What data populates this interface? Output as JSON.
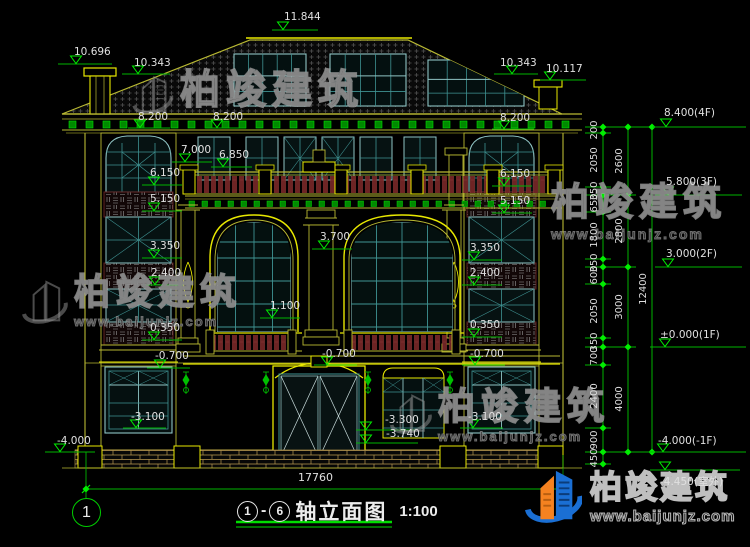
{
  "canvas": {
    "width": 750,
    "height": 547,
    "background": "#000000"
  },
  "brand": {
    "name": "柏竣建筑",
    "website": "www.baijunjz.com"
  },
  "title_block": {
    "axis_from": "1",
    "separator": "-",
    "axis_to": "6",
    "name": "轴立面图",
    "scale": "1:100"
  },
  "axis_bubble": "1",
  "dimensions": {
    "overall_width": "17760",
    "right_chain": {
      "line_x": [
        603,
        628,
        652
      ],
      "text_x": [
        595,
        620,
        644
      ],
      "ticks": [
        [
          127,
          133,
          187,
          195,
          212,
          259,
          267,
          284,
          338,
          347,
          365,
          428,
          452,
          464
        ],
        [
          127,
          195,
          267,
          347,
          452
        ],
        [
          127,
          452
        ]
      ],
      "labels": [
        [
          {
            "v": "200",
            "y": 130
          },
          {
            "v": "2050",
            "y": 160
          },
          {
            "v": "350",
            "y": 191
          },
          {
            "v": "650",
            "y": 203
          },
          {
            "v": "1800",
            "y": 235
          },
          {
            "v": "350",
            "y": 263
          },
          {
            "v": "600",
            "y": 275
          },
          {
            "v": "2050",
            "y": 311
          },
          {
            "v": "350",
            "y": 342
          },
          {
            "v": "700",
            "y": 356
          },
          {
            "v": "2400",
            "y": 396
          },
          {
            "v": "900",
            "y": 440
          },
          {
            "v": "450",
            "y": 458
          }
        ],
        [
          {
            "v": "2600",
            "y": 161
          },
          {
            "v": "2800",
            "y": 231
          },
          {
            "v": "3000",
            "y": 307
          },
          {
            "v": "4000",
            "y": 399
          }
        ],
        [
          {
            "v": "12400",
            "y": 289
          }
        ]
      ]
    }
  },
  "level_markers": [
    {
      "text": "11.844",
      "tx": 284,
      "ty": 12,
      "ly": 30,
      "lx1": 272,
      "lx2": 318,
      "trix": 283
    },
    {
      "text": "10.696",
      "tx": 74,
      "ty": 47,
      "ly": 64,
      "lx1": 58,
      "lx2": 112,
      "trix": 76
    },
    {
      "text": "10.343",
      "tx": 134,
      "ty": 58,
      "ly": 74,
      "lx1": 122,
      "lx2": 170,
      "trix": 138
    },
    {
      "text": "10.343",
      "tx": 500,
      "ty": 58,
      "ly": 74,
      "lx1": 494,
      "lx2": 538,
      "trix": 512
    },
    {
      "text": "10.117",
      "tx": 546,
      "ty": 64,
      "ly": 80,
      "lx1": 540,
      "lx2": 586,
      "trix": 550
    },
    {
      "text": "8.200",
      "tx": 138,
      "ty": 112,
      "ly": 128,
      "lx1": 128,
      "lx2": 170,
      "trix": 140
    },
    {
      "text": "8.200",
      "tx": 213,
      "ty": 112,
      "ly": 128,
      "lx1": 205,
      "lx2": 246,
      "trix": 217
    },
    {
      "text": "8.200",
      "tx": 500,
      "ty": 113,
      "ly": 129,
      "lx1": 492,
      "lx2": 534,
      "trix": 504
    },
    {
      "text": "7.000",
      "tx": 181,
      "ty": 145,
      "ly": 162,
      "lx1": 172,
      "lx2": 212,
      "trix": 185
    },
    {
      "text": "6.850",
      "tx": 219,
      "ty": 150,
      "ly": 167,
      "lx1": 211,
      "lx2": 252,
      "trix": 223
    },
    {
      "text": "6.150",
      "tx": 150,
      "ty": 168,
      "ly": 185,
      "lx1": 142,
      "lx2": 182,
      "trix": 154
    },
    {
      "text": "6.150",
      "tx": 500,
      "ty": 169,
      "ly": 186,
      "lx1": 492,
      "lx2": 532,
      "trix": 504
    },
    {
      "text": "5.150",
      "tx": 150,
      "ty": 194,
      "ly": 211,
      "lx1": 142,
      "lx2": 182,
      "trix": 154
    },
    {
      "text": "5.150",
      "tx": 500,
      "ty": 196,
      "ly": 213,
      "lx1": 492,
      "lx2": 532,
      "trix": 504
    },
    {
      "text": "3.700",
      "tx": 320,
      "ty": 232,
      "ly": 249,
      "lx1": 312,
      "lx2": 352,
      "trix": 324
    },
    {
      "text": "3.350",
      "tx": 150,
      "ty": 241,
      "ly": 258,
      "lx1": 142,
      "lx2": 182,
      "trix": 154
    },
    {
      "text": "3.350",
      "tx": 470,
      "ty": 243,
      "ly": 260,
      "lx1": 462,
      "lx2": 502,
      "trix": 474
    },
    {
      "text": "2.400",
      "tx": 151,
      "ty": 268,
      "ly": 285,
      "lx1": 143,
      "lx2": 183,
      "trix": 155
    },
    {
      "text": "2.400",
      "tx": 470,
      "ty": 268,
      "ly": 285,
      "lx1": 462,
      "lx2": 502,
      "trix": 474
    },
    {
      "text": "1.100",
      "tx": 270,
      "ty": 301,
      "ly": 318,
      "lx1": 260,
      "lx2": 300,
      "trix": 272
    },
    {
      "text": "0.350",
      "tx": 150,
      "ty": 323,
      "ly": 340,
      "lx1": 142,
      "lx2": 182,
      "trix": 154
    },
    {
      "text": "0.350",
      "tx": 470,
      "ty": 320,
      "ly": 337,
      "lx1": 462,
      "lx2": 502,
      "trix": 474
    },
    {
      "text": "-0.700",
      "tx": 155,
      "ty": 351,
      "ly": 368,
      "lx1": 147,
      "lx2": 190,
      "trix": 160
    },
    {
      "text": "-0.700",
      "tx": 322,
      "ty": 349,
      "ly": 365,
      "lx1": 314,
      "lx2": 357,
      "trix": 327
    },
    {
      "text": "-0.700",
      "tx": 470,
      "ty": 349,
      "ly": 365,
      "lx1": 462,
      "lx2": 505,
      "trix": 475
    },
    {
      "text": "-3.100",
      "tx": 131,
      "ty": 412,
      "ly": 428,
      "lx1": 123,
      "lx2": 166,
      "trix": 136
    },
    {
      "text": "-3.100",
      "tx": 468,
      "ty": 412,
      "ly": 428,
      "lx1": 460,
      "lx2": 503,
      "trix": 473
    },
    {
      "text": "-3.300",
      "tx": 385,
      "ty": 415,
      "ly": 430,
      "lx1": 356,
      "lx2": 416,
      "trix": 366
    },
    {
      "text": "-3.740",
      "tx": 386,
      "ty": 429,
      "ly": 443,
      "lx1": 356,
      "lx2": 418,
      "trix": 366
    },
    {
      "text": "-4.000",
      "tx": 57,
      "ty": 436,
      "ly": 452,
      "lx1": 45,
      "lx2": 95,
      "trix": 60
    },
    {
      "text": "8.400(4F)",
      "tx": 664,
      "ty": 108,
      "ly": 127,
      "lx1": 653,
      "lx2": 746,
      "trix": 666
    },
    {
      "text": "5.800(3F)",
      "tx": 666,
      "ty": 177,
      "ly": 195,
      "lx1": 655,
      "lx2": 742,
      "trix": 668
    },
    {
      "text": "3.000(2F)",
      "tx": 666,
      "ty": 249,
      "ly": 267,
      "lx1": 655,
      "lx2": 742,
      "trix": 668
    },
    {
      "text": "±0.000(1F)",
      "tx": 660,
      "ty": 330,
      "ly": 347,
      "lx1": 650,
      "lx2": 746,
      "trix": 665
    },
    {
      "text": "-4.000(-1F)",
      "tx": 658,
      "ty": 436,
      "ly": 452,
      "lx1": 648,
      "lx2": 746,
      "trix": 663
    },
    {
      "text": "-4.450(室外)",
      "tx": 660,
      "ty": 477,
      "ly": 470,
      "lx1": 650,
      "lx2": 740,
      "trix": 665,
      "below": true
    }
  ],
  "colors": {
    "dimension_green": "#00b400",
    "bright_green": "#00ee00",
    "outline_yellow": "#b9b932",
    "bright_yellow": "#e8e800",
    "window_teal": "#3f9393",
    "window_frame": "#8fc4c4",
    "text_white": "#e0e0e0",
    "lattice_red": "#6e2424",
    "logo_blue": "#1a6fd4",
    "logo_orange": "#f58220"
  }
}
